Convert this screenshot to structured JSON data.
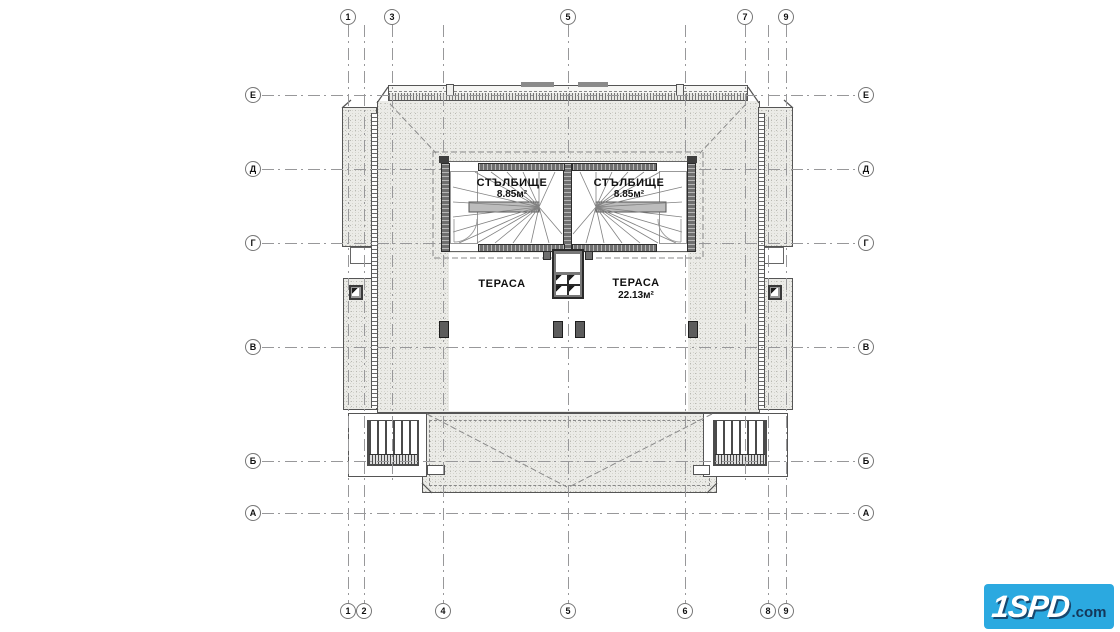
{
  "drawing": {
    "grid": {
      "top": [
        "1",
        "3",
        "5",
        "7",
        "9"
      ],
      "bottom": [
        "1",
        "2",
        "4",
        "5",
        "6",
        "8",
        "9"
      ],
      "left": [
        "Е",
        "Д",
        "Г",
        "В",
        "Б",
        "А"
      ],
      "right": [
        "Е",
        "Д",
        "Г",
        "В",
        "Б",
        "А"
      ]
    },
    "rooms": {
      "stair_left": {
        "name": "СТЪЛБИЩЕ",
        "area": "8.85м²"
      },
      "stair_right": {
        "name": "СТЪЛБИЩЕ",
        "area": "8.85м²"
      },
      "terrace_left": {
        "name": "ТЕРАСА"
      },
      "terrace_right": {
        "name": "ТЕРАСА",
        "area": "22.13м²"
      }
    }
  },
  "logo": {
    "brand": "1SPD",
    "suffix": ".com",
    "bg": "#2BA9E0",
    "brand_color": "#ffffff",
    "suffix_color": "#14375A"
  },
  "colors": {
    "paper": "#ffffff",
    "line": "#555555",
    "grid_line": "#98989a",
    "roof_fill": "#ebebe7",
    "wall_fill": "#6f6f6f"
  }
}
